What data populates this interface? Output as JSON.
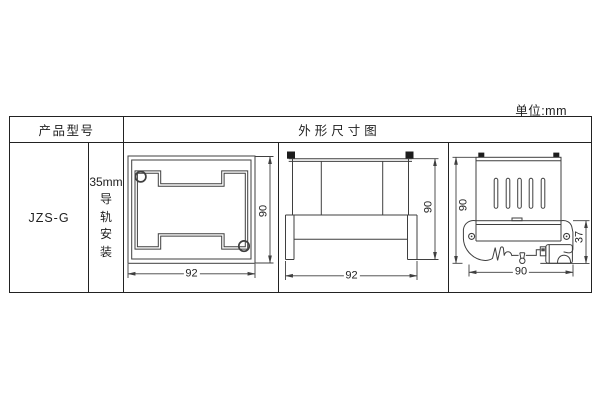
{
  "unit_note": "单位:mm",
  "table": {
    "header": {
      "product_model": "产品型号",
      "dimension_diagram": "外形尺寸图"
    },
    "row": {
      "model": "JZS-G",
      "mounting": {
        "line1": "35mm",
        "chars": [
          "导",
          "轨",
          "安",
          "装"
        ]
      }
    }
  },
  "drawings": {
    "front_view": {
      "width": "92",
      "height": "90"
    },
    "side_view": {
      "width": "92",
      "height": "90"
    },
    "rail_view": {
      "height": "90",
      "depth": "37",
      "width": "90"
    }
  },
  "colors": {
    "table_border": "#222222",
    "drawing_line": "#3f3f3f",
    "clip_fill": "#1c1c1c",
    "background": "#ffffff"
  }
}
